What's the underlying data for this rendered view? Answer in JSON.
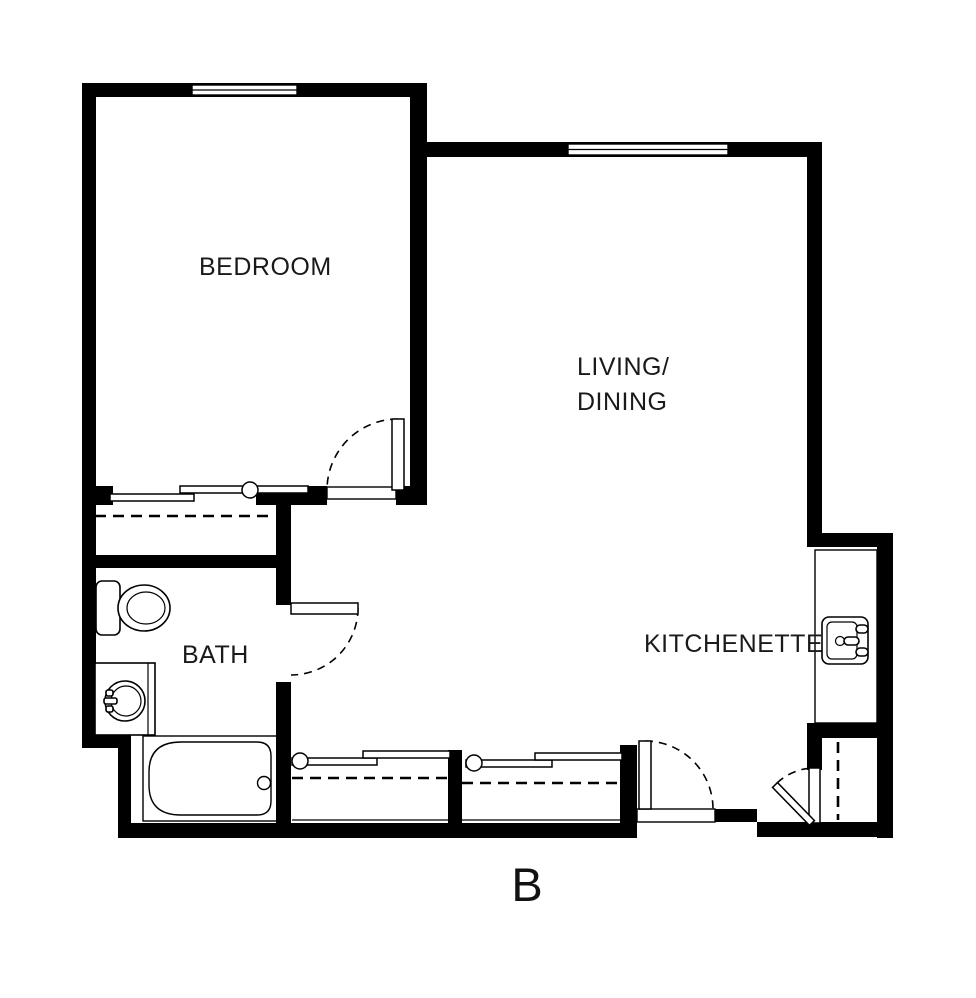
{
  "plan": {
    "unit_letter": "B",
    "rooms": {
      "bedroom": "BEDROOM",
      "living_dining": {
        "line1": "LIVING/",
        "line2": "DINING"
      },
      "bath": "BATH",
      "kitchenette": "KITCHENETTE"
    },
    "colors": {
      "walls": "#000000",
      "background": "#ffffff"
    },
    "fixtures": [
      "toilet",
      "bathroom-vanity-sink",
      "bathtub",
      "kitchen-counter",
      "kitchen-sink",
      "bedroom-window",
      "living-dining-window",
      "bedroom-swing-door",
      "bath-swing-door",
      "entry-swing-door",
      "utility-closet-door",
      "bedroom-closet-sliding-doors",
      "hall-closet-1-sliding-doors",
      "hall-closet-2-sliding-doors",
      "closet-hanging-rods"
    ]
  }
}
